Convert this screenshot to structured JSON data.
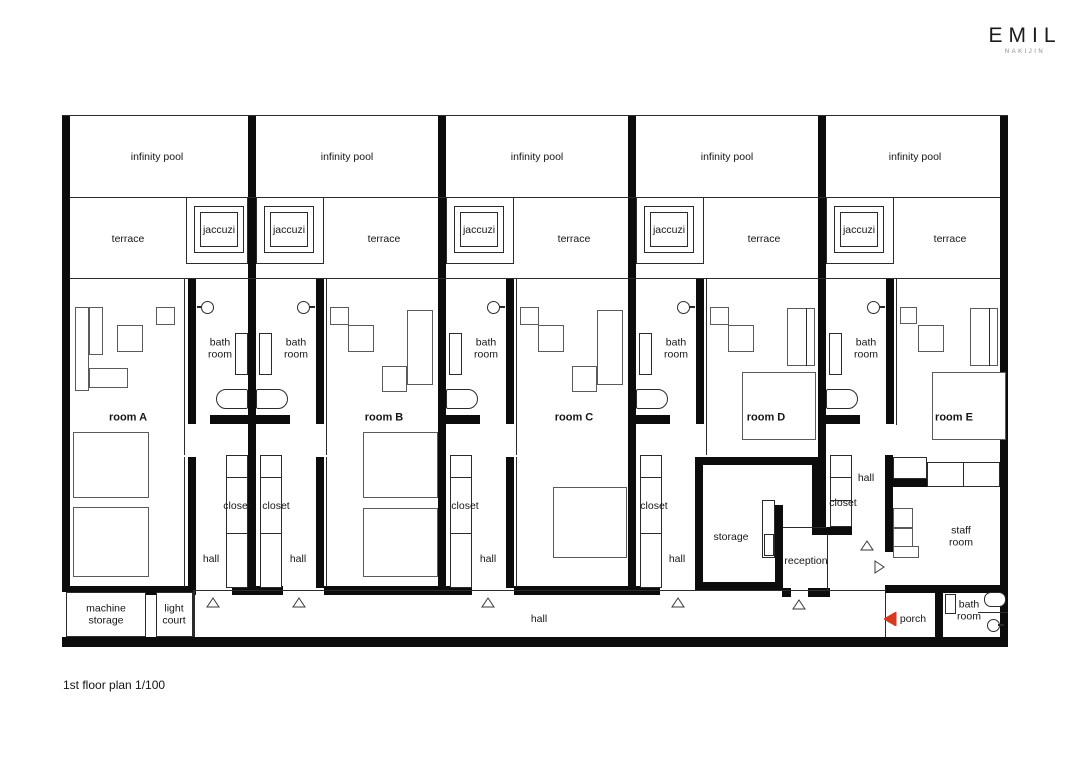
{
  "brand": {
    "name": "EMIL",
    "location": "NAKIJIN"
  },
  "plan_title": "1st floor plan 1/100",
  "colors": {
    "wall": "#0c0c0c",
    "line": "#2b2b2b",
    "furniture": "#5a5a5a",
    "accent_red": "#d63a20"
  },
  "units": [
    {
      "room": "room A",
      "pool": "infinity pool",
      "terrace": "terrace",
      "jacuzzi": "jaccuzi",
      "bath": "bath room",
      "closet": "closet",
      "hall": "hall"
    },
    {
      "room": "room B",
      "pool": "infinity pool",
      "terrace": "terrace",
      "jacuzzi": "jaccuzi",
      "bath": "bath room",
      "closet": "closet",
      "hall": "hall"
    },
    {
      "room": "room C",
      "pool": "infinity pool",
      "terrace": "terrace",
      "jacuzzi": "jaccuzi",
      "bath": "bath room",
      "closet": "closet",
      "hall": "hall"
    },
    {
      "room": "room D",
      "pool": "infinity pool",
      "terrace": "terrace",
      "jacuzzi": "jaccuzi",
      "bath": "bath room",
      "closet": "closet",
      "hall": "hall"
    },
    {
      "room": "room E",
      "pool": "infinity pool",
      "terrace": "terrace",
      "jacuzzi": "jaccuzi",
      "bath": "bath room",
      "closet": "closet",
      "hall": "hall"
    }
  ],
  "service": {
    "machine_storage": "machine storage",
    "light_court": "light court",
    "main_hall": "hall",
    "storage": "storage",
    "reception": "reception",
    "staff_room": "staff room",
    "porch": "porch",
    "staff_bath": "bath room"
  }
}
